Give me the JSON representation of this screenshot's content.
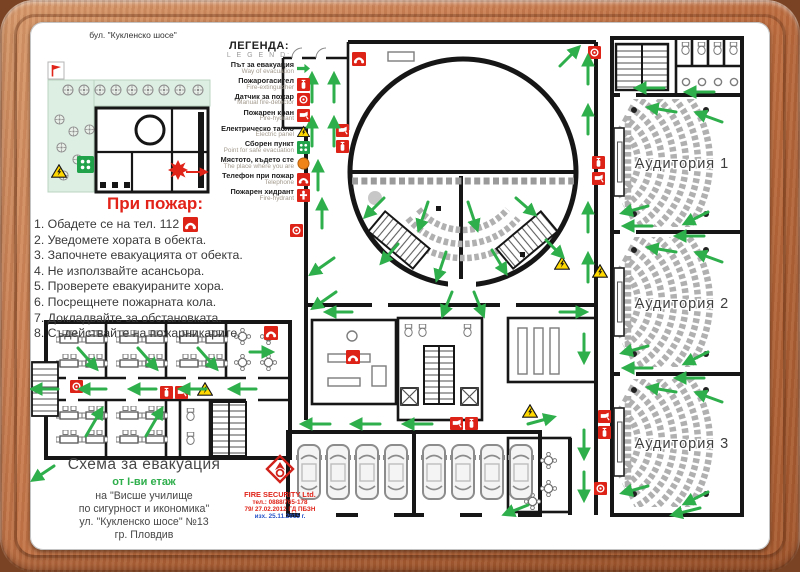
{
  "site_map": {
    "street_label": "бул. \"Кукленско шосе\""
  },
  "legend": {
    "title_bg": "ЛЕГЕНДА:",
    "title_en": "L E G E N D:",
    "items": [
      {
        "bg": "Път за евакуация",
        "en": "Way of evacuation",
        "icon": "evacuation-arrow"
      },
      {
        "bg": "Пожарогасител",
        "en": "Fire-extinguisher",
        "icon": "fire-extinguisher"
      },
      {
        "bg": "Датчик за пожар",
        "en": "Manual fire-detector",
        "icon": "fire-detector"
      },
      {
        "bg": "Пожарен кран",
        "en": "Fire-hydrant",
        "icon": "fire-crane"
      },
      {
        "bg": "Електрическо табло",
        "en": "Electric panel",
        "icon": "electric-panel"
      },
      {
        "bg": "Сборен пункт",
        "en": "Point for safe evacuation",
        "icon": "assembly-point"
      },
      {
        "bg": "Мястото, където сте",
        "en": "The place where you are",
        "icon": "you-are-here"
      },
      {
        "bg": "Телефон при пожар",
        "en": "Telephone",
        "icon": "telephone"
      },
      {
        "bg": "Пожарен хидрант",
        "en": "Fire-hydrant",
        "icon": "hydrant"
      }
    ]
  },
  "fire_instructions": {
    "title": "При пожар:",
    "items": [
      "1. Обадете се на тел. 112",
      "2. Уведомете хората в обекта.",
      "3. Започнете евакуацията от обекта.",
      "4. Не използвайте асансьора.",
      "5. Проверете евакуираните хора.",
      "6. Посрещнете пожарната кола.",
      "7. Докладвайте за обстановката.",
      "8. Съдействайте на пожарникарите."
    ]
  },
  "plan_labels": {
    "auditorium_1": "Аудитория 1",
    "auditorium_2": "Аудитория 2",
    "auditorium_3": "Аудитория 3"
  },
  "title_block": {
    "title": "Схема за евакуация",
    "floor": "от I-ви етаж",
    "line1": "на \"Висше училище",
    "line2": "по сигурност и икономика\"",
    "line3": "ул. \"Кукленско шосе\" №13",
    "line4": "гр. Пловдив"
  },
  "company": {
    "name": "FIRE SECURITY Ltd.",
    "phone": "тел.: 0888/765-178",
    "license": "79/ 27.02.2012 ГД ПБЗН",
    "date": "изх. 25.11.2015 г."
  },
  "colors": {
    "evacuation_green": "#2fae4c",
    "safety_red": "#dd2218",
    "warning_yellow": "#ffd800",
    "wood_frame": "#bc6c3f"
  }
}
